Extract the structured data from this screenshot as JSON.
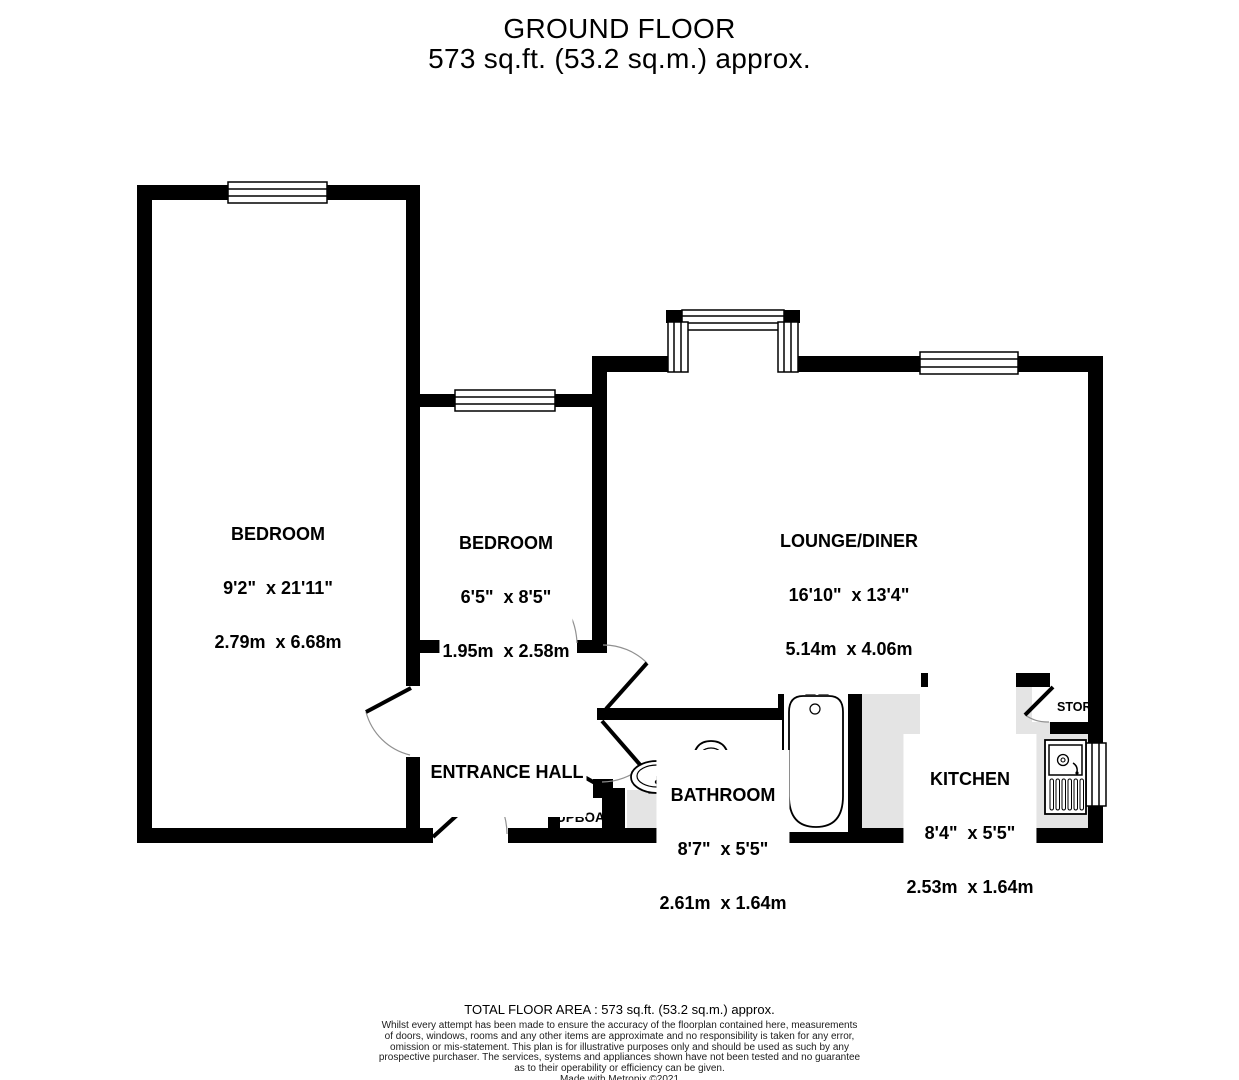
{
  "colors": {
    "wall": "#000000",
    "floor_shading": "#e4e4e4",
    "background": "#ffffff",
    "door_arc": "#909090"
  },
  "title": {
    "line1": "GROUND FLOOR",
    "line2": "573 sq.ft. (53.2 sq.m.) approx."
  },
  "rooms": {
    "bedroom_main": {
      "name": "BEDROOM",
      "imperial": "9'2\"  x 21'11\"",
      "metric": "2.79m  x 6.68m"
    },
    "bedroom_second": {
      "name": "BEDROOM",
      "imperial": "6'5\"  x 8'5\"",
      "metric": "1.95m  x 2.58m"
    },
    "lounge_diner": {
      "name": "LOUNGE/DINER",
      "imperial": "16'10\"  x 13'4\"",
      "metric": "5.14m  x 4.06m"
    },
    "entrance_hall": {
      "name": "ENTRANCE HALL"
    },
    "bathroom": {
      "name": "BATHROOM",
      "imperial": "8'7\"  x 5'5\"",
      "metric": "2.61m  x 1.64m"
    },
    "kitchen": {
      "name": "KITCHEN",
      "imperial": "8'4\"  x 5'5\"",
      "metric": "2.53m  x 1.64m"
    },
    "storage": {
      "label": "STOR"
    },
    "cupboard": {
      "label": "UPBOAR"
    }
  },
  "fixtures": [
    "bathtub",
    "toilet",
    "wash-basin",
    "cooker-hob",
    "kitchen-sink",
    "window",
    "door-swing"
  ],
  "footer": {
    "total_area": "TOTAL FLOOR AREA : 573 sq.ft. (53.2 sq.m.) approx.",
    "disclaimer_lines": [
      "Whilst every attempt has been made to ensure the accuracy of the floorplan contained here, measurements",
      "of doors, windows, rooms and any other items are approximate and no responsibility is taken for any error,",
      "omission or mis-statement. This plan is for illustrative purposes only and should be used as such by any",
      "prospective purchaser. The services, systems and appliances shown have not been tested and no guarantee",
      "as to their operability or efficiency can be given."
    ],
    "credit": "Made with Metropix ©2021"
  }
}
